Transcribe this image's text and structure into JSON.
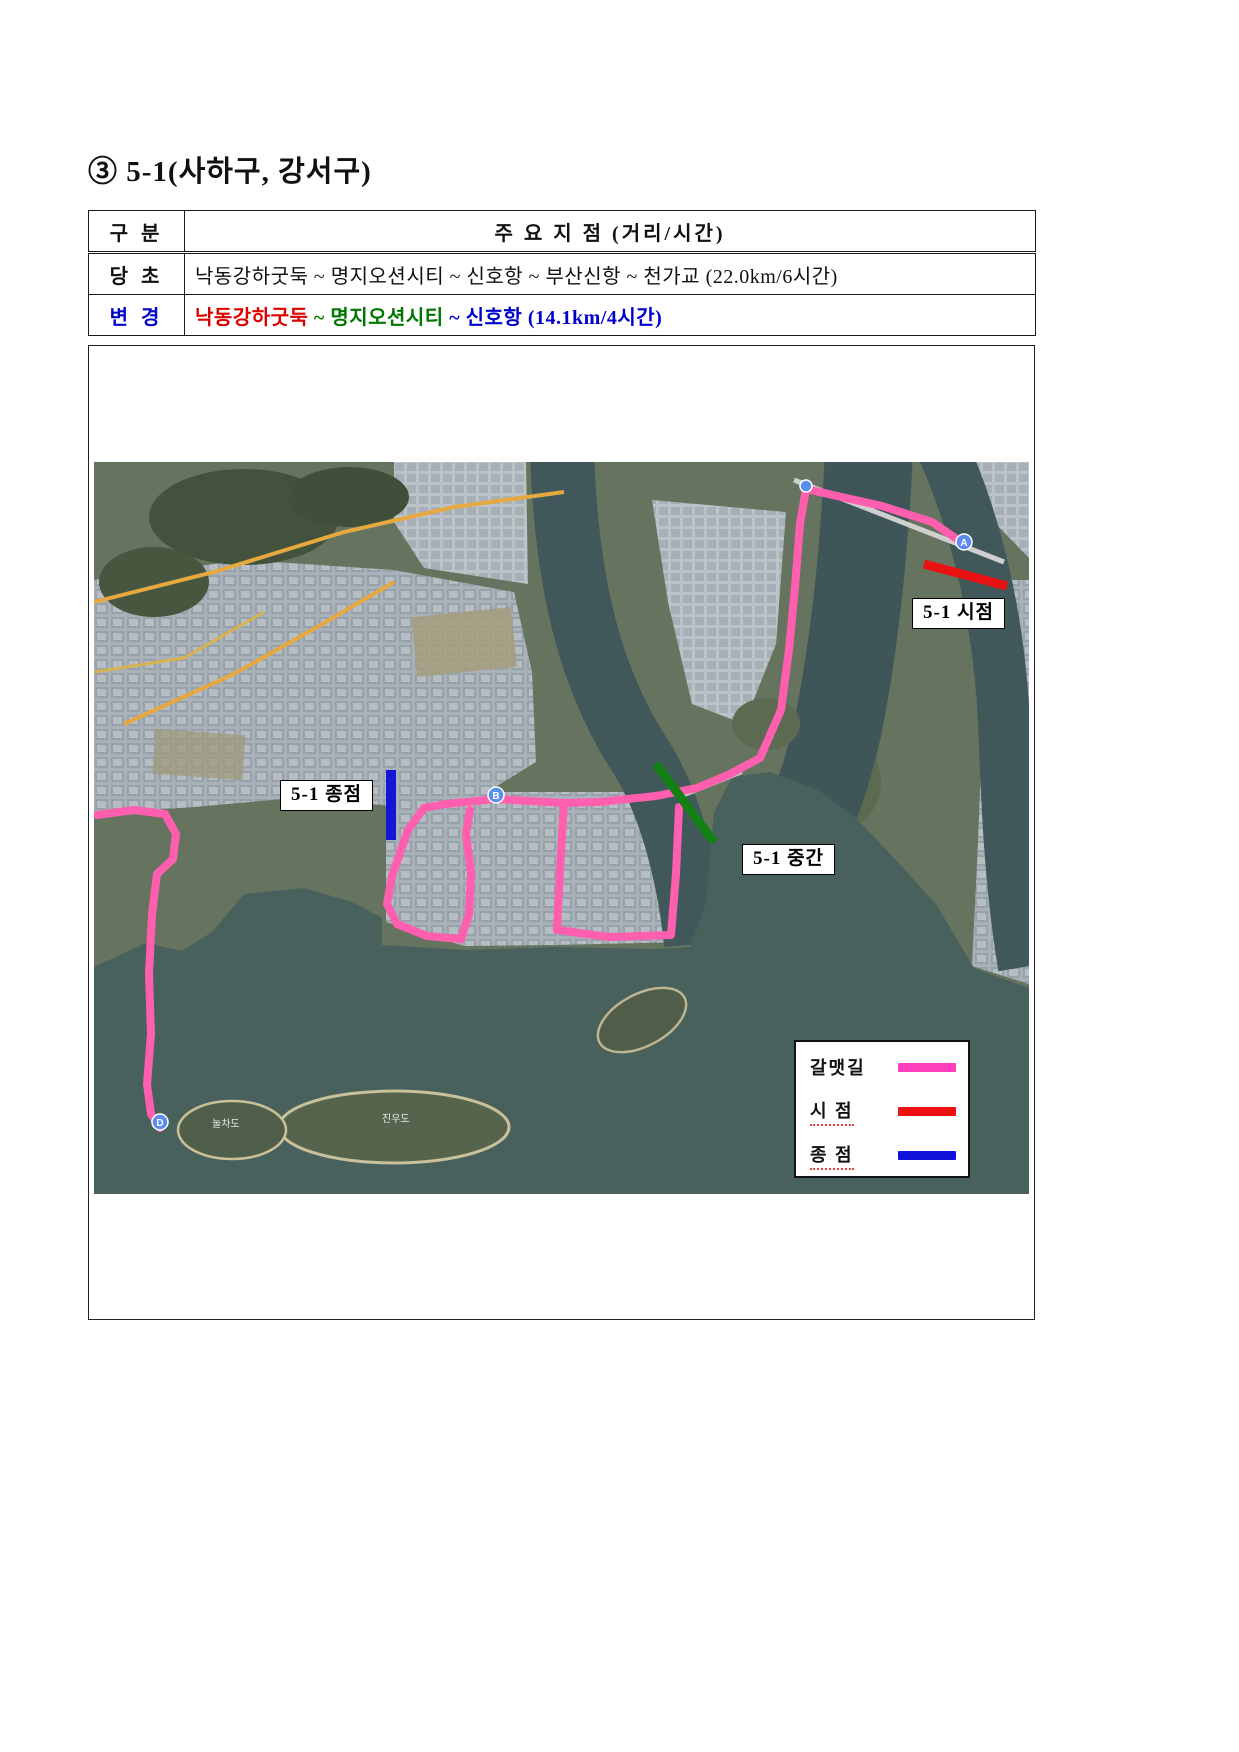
{
  "page": {
    "title": "③ 5-1(사하구, 강서구)"
  },
  "table": {
    "header": {
      "col1": "구 분",
      "col2": "주 요 지 점 (거리/시간)"
    },
    "rows": [
      {
        "label": "당  초",
        "label_color": "#111111",
        "segments": [
          {
            "text": "낙동강하굿둑 ~ 명지오션시티 ~ 신호항 ~ 부산신항 ~ 천가교 (22.0km/6시간)",
            "color": "#111111"
          }
        ]
      },
      {
        "label": "변  경",
        "label_color": "#0000cc",
        "segments": [
          {
            "text": "낙동강하굿둑",
            "color": "#dd0000"
          },
          {
            "text": " ~ ",
            "color": "#007700"
          },
          {
            "text": "명지오션시티",
            "color": "#007700"
          },
          {
            "text": " ~ ",
            "color": "#0000cc"
          },
          {
            "text": "신호항 (14.1km/4시간)",
            "color": "#0000cc"
          }
        ]
      }
    ]
  },
  "map": {
    "labels": {
      "start": "5-1 시점",
      "end": "5-1 종점",
      "mid": "5-1 중간"
    },
    "legend": {
      "items": [
        {
          "label": "갈맷길",
          "color": "#ff3fbe"
        },
        {
          "label": "시  점",
          "color": "#ee1111"
        },
        {
          "label": "종  점",
          "color": "#1212dd"
        }
      ]
    },
    "islands": [
      {
        "name": "눌차도"
      },
      {
        "name": "진우도"
      }
    ],
    "markers": [
      {
        "letter": "A"
      },
      {
        "letter": "B"
      },
      {
        "letter": "D"
      }
    ],
    "colors": {
      "route": "#ff5fae",
      "start_seg": "#e81212",
      "end_seg": "#1515d5",
      "mid_seg": "#128012",
      "water": "#48615c"
    }
  }
}
